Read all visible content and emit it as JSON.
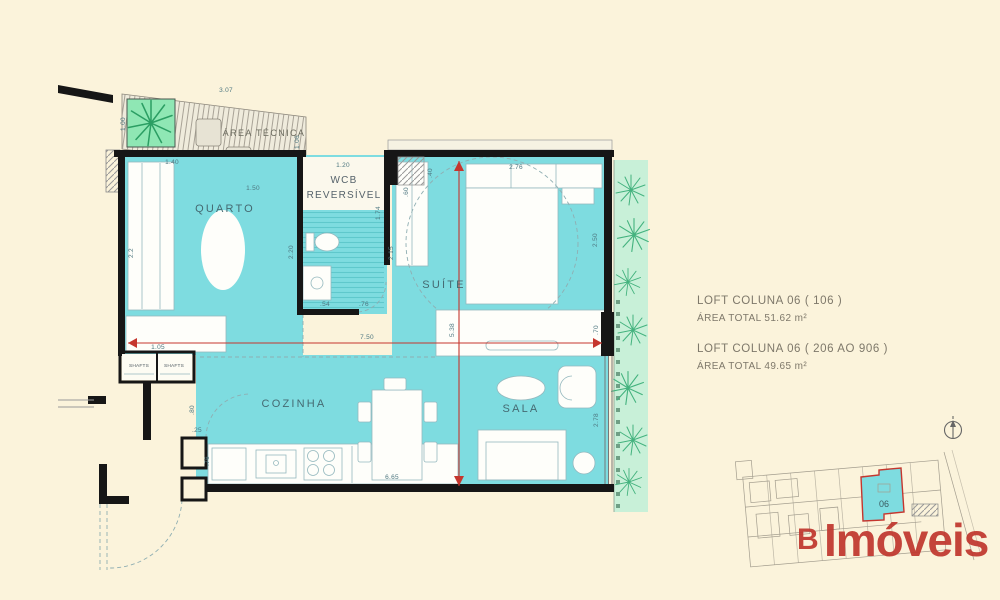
{
  "rooms": {
    "quarto": "QUARTO",
    "wcb1": "WCB",
    "wcb2": "REVERSÍVEL",
    "suite": "SUÍTE",
    "cozinha": "COZINHA",
    "sala": "SALA",
    "tecnica": "ÁREA TÉCNICA",
    "shaft1": "SHAFTS",
    "shaft2": "SHAFTS"
  },
  "dims": {
    "area_top": "3.07",
    "area_side": "1.06",
    "plant": "1.00",
    "quarto_w1": "1.40",
    "quarto_w2": "1.50",
    "quarto_h": "2.2",
    "wcb_w": "1.20",
    "wcb_h": "2.20",
    "wcb_h2": "1.74",
    "wcb_b1": ".54",
    "wcb_b2": ".76",
    "suite_w": "2.76",
    "suite_h": "2.50",
    "closet_h": "2.15",
    "closet_w": ".60",
    "pillar": ".40",
    "sill": ".70",
    "hall": "1.05",
    "entry_w": ".25",
    "entry_h": ".76",
    "entry_d": ".80",
    "kitchen_w": "6.65",
    "sala_h": "2.78",
    "total_w": "7.50",
    "total_h": "5.38"
  },
  "annotation": {
    "title1": "LOFT COLUNA 06 ( 106 )",
    "area1": "ÁREA TOTAL  51.62 m²",
    "title2": "LOFT COLUNA 06 ( 206 AO 906 )",
    "area2": "ÁREA TOTAL  49.65 m²"
  },
  "keyplan": {
    "unit": "06"
  },
  "logo": {
    "mark": "B",
    "name": "Imóveis"
  },
  "colors": {
    "background": "#FBF3DB",
    "room_fill": "#7EDCE0",
    "wall": "#161616",
    "garden": "#C8F0D8",
    "plant": "#44B27E",
    "dim_red": "#C5362E",
    "logo_red": "#C0372E"
  }
}
